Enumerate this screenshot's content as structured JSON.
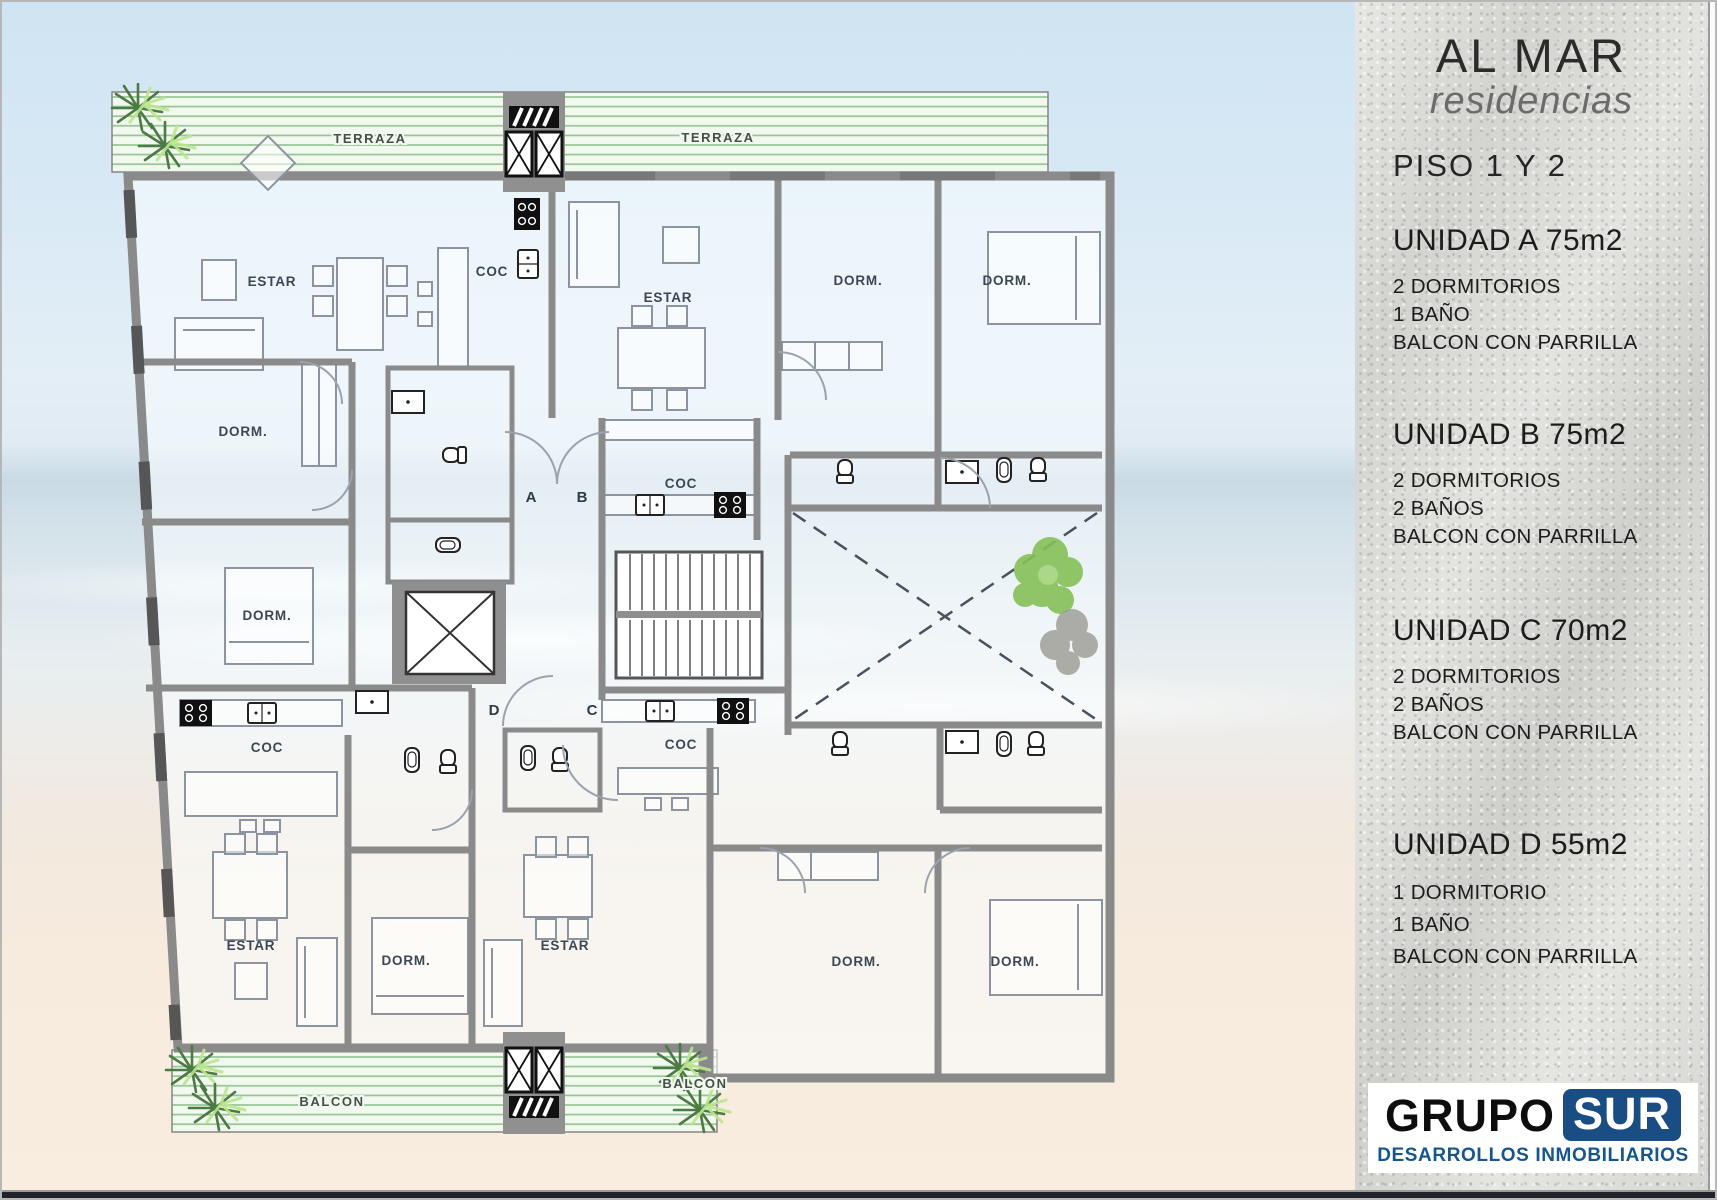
{
  "sidebar": {
    "brand": {
      "title": "AL MAR",
      "subtitle": "residencias"
    },
    "floor_label": "PISO  1 Y 2",
    "units": [
      {
        "name": "UNIDAD A 75m2",
        "features": [
          "2 DORMITORIOS",
          "1 BAÑO",
          "BALCON CON PARRILLA"
        ]
      },
      {
        "name": "UNIDAD B 75m2",
        "features": [
          "2 DORMITORIOS",
          "2 BAÑOS",
          "BALCON CON PARRILLA"
        ]
      },
      {
        "name": "UNIDAD C 70m2",
        "features": [
          "2 DORMITORIOS",
          "2 BAÑOS",
          "BALCON CON PARRILLA"
        ]
      },
      {
        "name": "UNIDAD D 55m2",
        "features": [
          "1 DORMITORIO",
          "1 BAÑO",
          "BALCON CON PARRILLA"
        ]
      }
    ],
    "logo": {
      "primary": "GRUPO",
      "secondary": "SUR",
      "tagline": "DESARROLLOS INMOBILIARIOS"
    }
  },
  "plan": {
    "terraza_labels": [
      "TERRAZA",
      "TERRAZA"
    ],
    "balcon_labels": [
      "BALCON",
      "BALCON"
    ],
    "door_labels": [
      "A",
      "B",
      "D",
      "C"
    ],
    "room_labels": [
      "ESTAR",
      "COC",
      "ESTAR",
      "DORM.",
      "DORM.",
      "DORM.",
      "DORM.",
      "COC",
      "COC",
      "COC",
      "ESTAR",
      "DORM.",
      "ESTAR",
      "DORM.",
      "DORM."
    ],
    "icons": [
      "palm-tree",
      "courtyard-tree",
      "elevator",
      "stairs",
      "toilet",
      "bidet",
      "vanity-sink",
      "kitchen-sink",
      "stove",
      "vent-hatch"
    ]
  },
  "colors": {
    "logo_blue": "#1b4d85",
    "tagline_blue": "#15568f",
    "wall_gray": "#8a8a8a",
    "terraza_green": "#96c496",
    "text_dark": "#1c1c1c"
  }
}
